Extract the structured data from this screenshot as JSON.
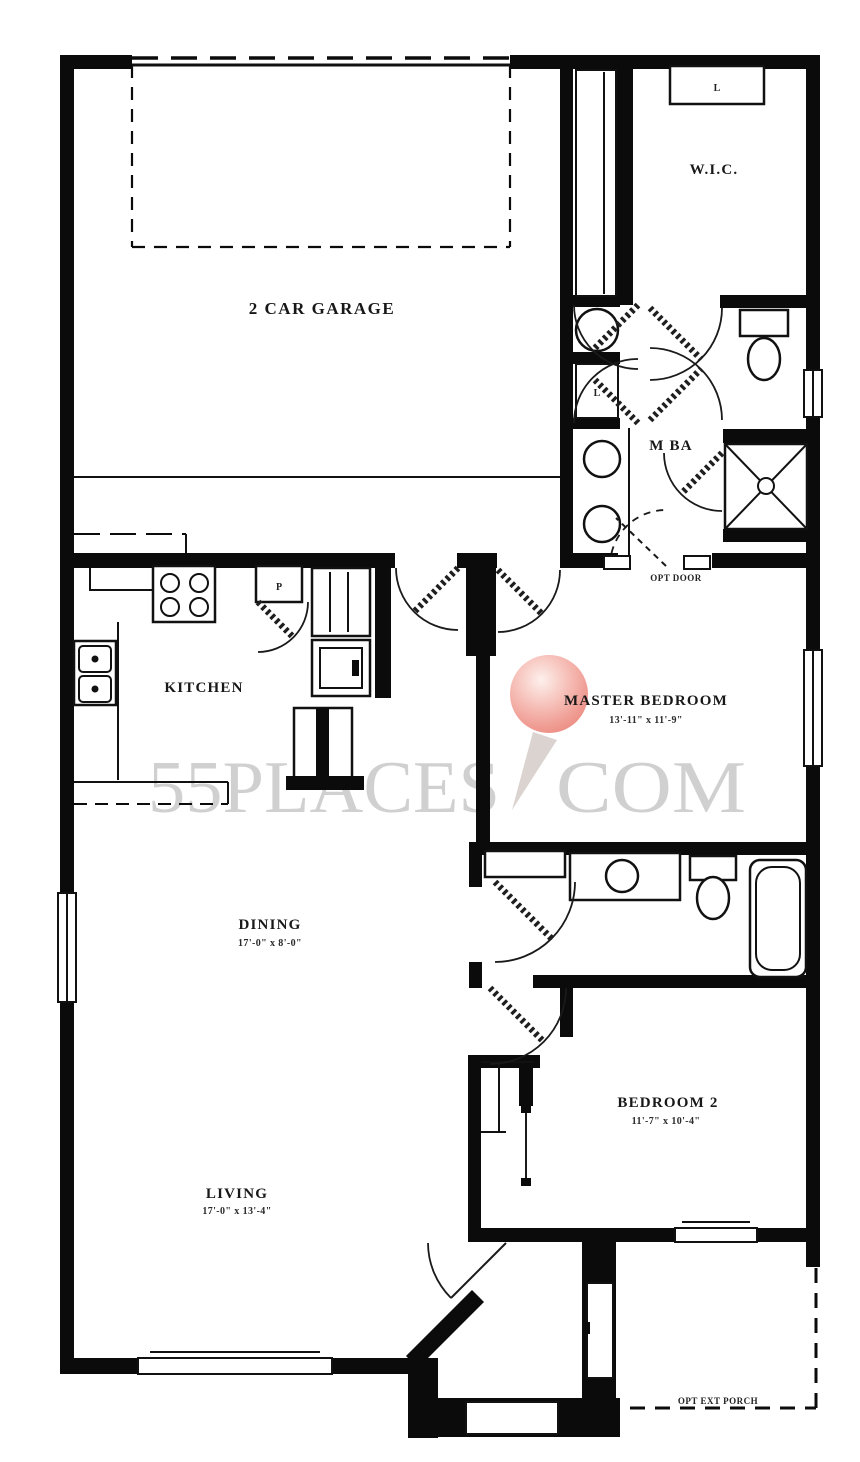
{
  "plan": {
    "rooms": [
      {
        "name": "2 CAR GARAGE",
        "dims": ""
      },
      {
        "name": "W.I.C.",
        "dims": ""
      },
      {
        "name": "M BA",
        "dims": ""
      },
      {
        "name": "KITCHEN",
        "dims": ""
      },
      {
        "name": "MASTER BEDROOM",
        "dims": "13'-11\" x 11'-9\""
      },
      {
        "name": "DINING",
        "dims": "17'-0\" x 8'-0\""
      },
      {
        "name": "BEDROOM 2",
        "dims": "11'-7\" x 10'-4\""
      },
      {
        "name": "LIVING",
        "dims": "17'-0\" x 13'-4\""
      }
    ],
    "annotations": {
      "opt_door": "OPT DOOR",
      "opt_ext_porch": "OPT EXT PORCH"
    },
    "closet_labels": {
      "wic_shelf": "L",
      "linen": "L",
      "pantry": "P"
    },
    "fixtures": [
      "range-cooktop",
      "double-sink",
      "refrigerator",
      "wall-oven",
      "kitchen-island",
      "laundry-tub",
      "vanity-sink",
      "vanity-sink",
      "toilet",
      "shower",
      "bathtub",
      "vanity-sink",
      "toilet",
      "entry-stoop",
      "closet-shelves"
    ],
    "colors": {
      "wall": "#0b0b0b",
      "floor": "#ffffff",
      "watermark_gray": "#c9c9c9",
      "pin_red": "#ee8e84"
    }
  },
  "watermark": {
    "text_left": "55PLACES",
    "text_right": "COM"
  }
}
